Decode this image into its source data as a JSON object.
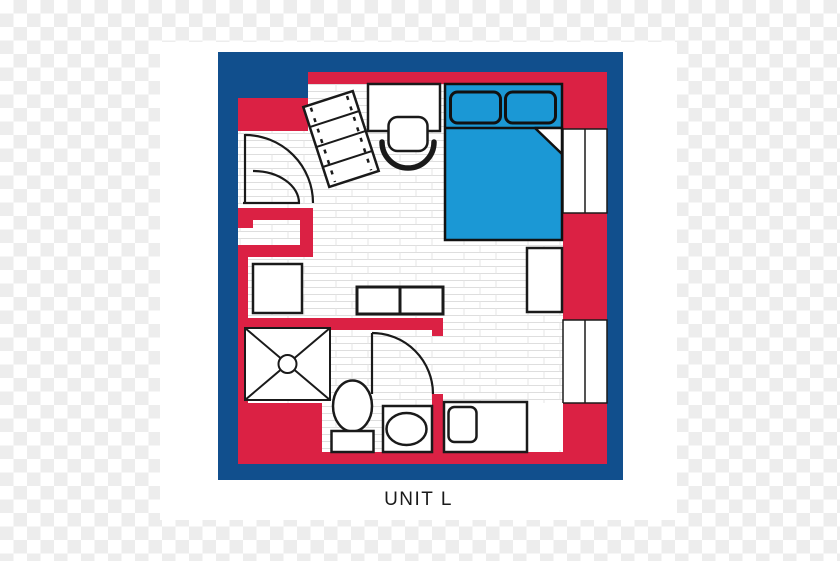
{
  "unit": {
    "label": "UNIT L",
    "type": "studio-floor-plan"
  },
  "colors": {
    "frame_blue": "#114F8D",
    "wall_red": "#DB2144",
    "bed_blue": "#1B98D5",
    "line_black": "#1A1A1A",
    "tile_line": "#DEDEDE",
    "checker_gray": "#EDEDED",
    "paper_white": "#FFFFFF"
  },
  "elements": [
    "bed",
    "pillow-left",
    "pillow-right",
    "blanket-fold",
    "desk",
    "desk-chair",
    "bookshelf",
    "wardrobe",
    "nightstand",
    "storage-boxes",
    "kitchen-counter",
    "counter-appliance",
    "shower",
    "toilet",
    "bathroom-sink",
    "entry-door",
    "bathroom-door",
    "window-upper-right",
    "window-lower-right"
  ]
}
